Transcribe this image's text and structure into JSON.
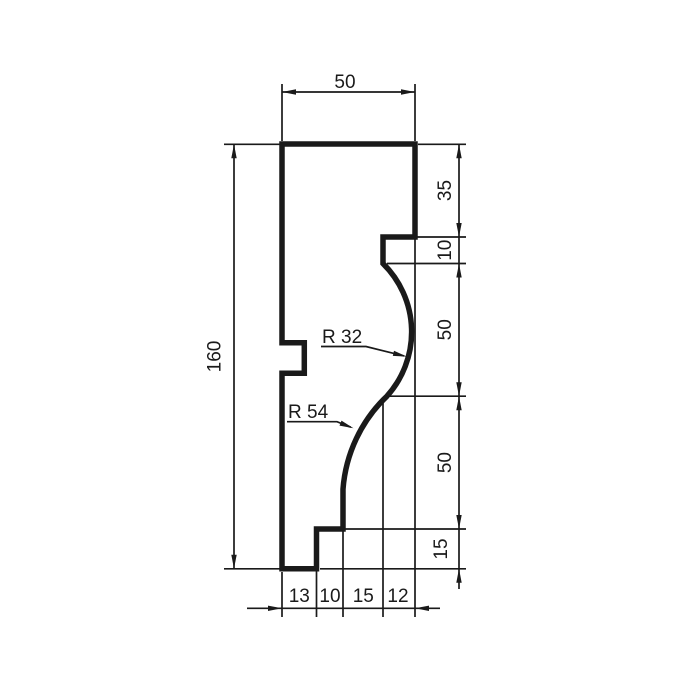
{
  "colors": {
    "background": "#ffffff",
    "line": "#1a1a1a"
  },
  "dimensions": {
    "top_width": 50,
    "total_height": 160,
    "right_heights": [
      35,
      10,
      50,
      50,
      15
    ],
    "bottom_widths": [
      13,
      10,
      15,
      12
    ],
    "radii": [
      32,
      54
    ]
  },
  "labels": {
    "top_width": "50",
    "total_height": "160",
    "right": [
      "35",
      "10",
      "50",
      "50",
      "15"
    ],
    "bottom": [
      "13",
      "10",
      "15",
      "12"
    ],
    "r32": "R 32",
    "r54": "R 54"
  }
}
